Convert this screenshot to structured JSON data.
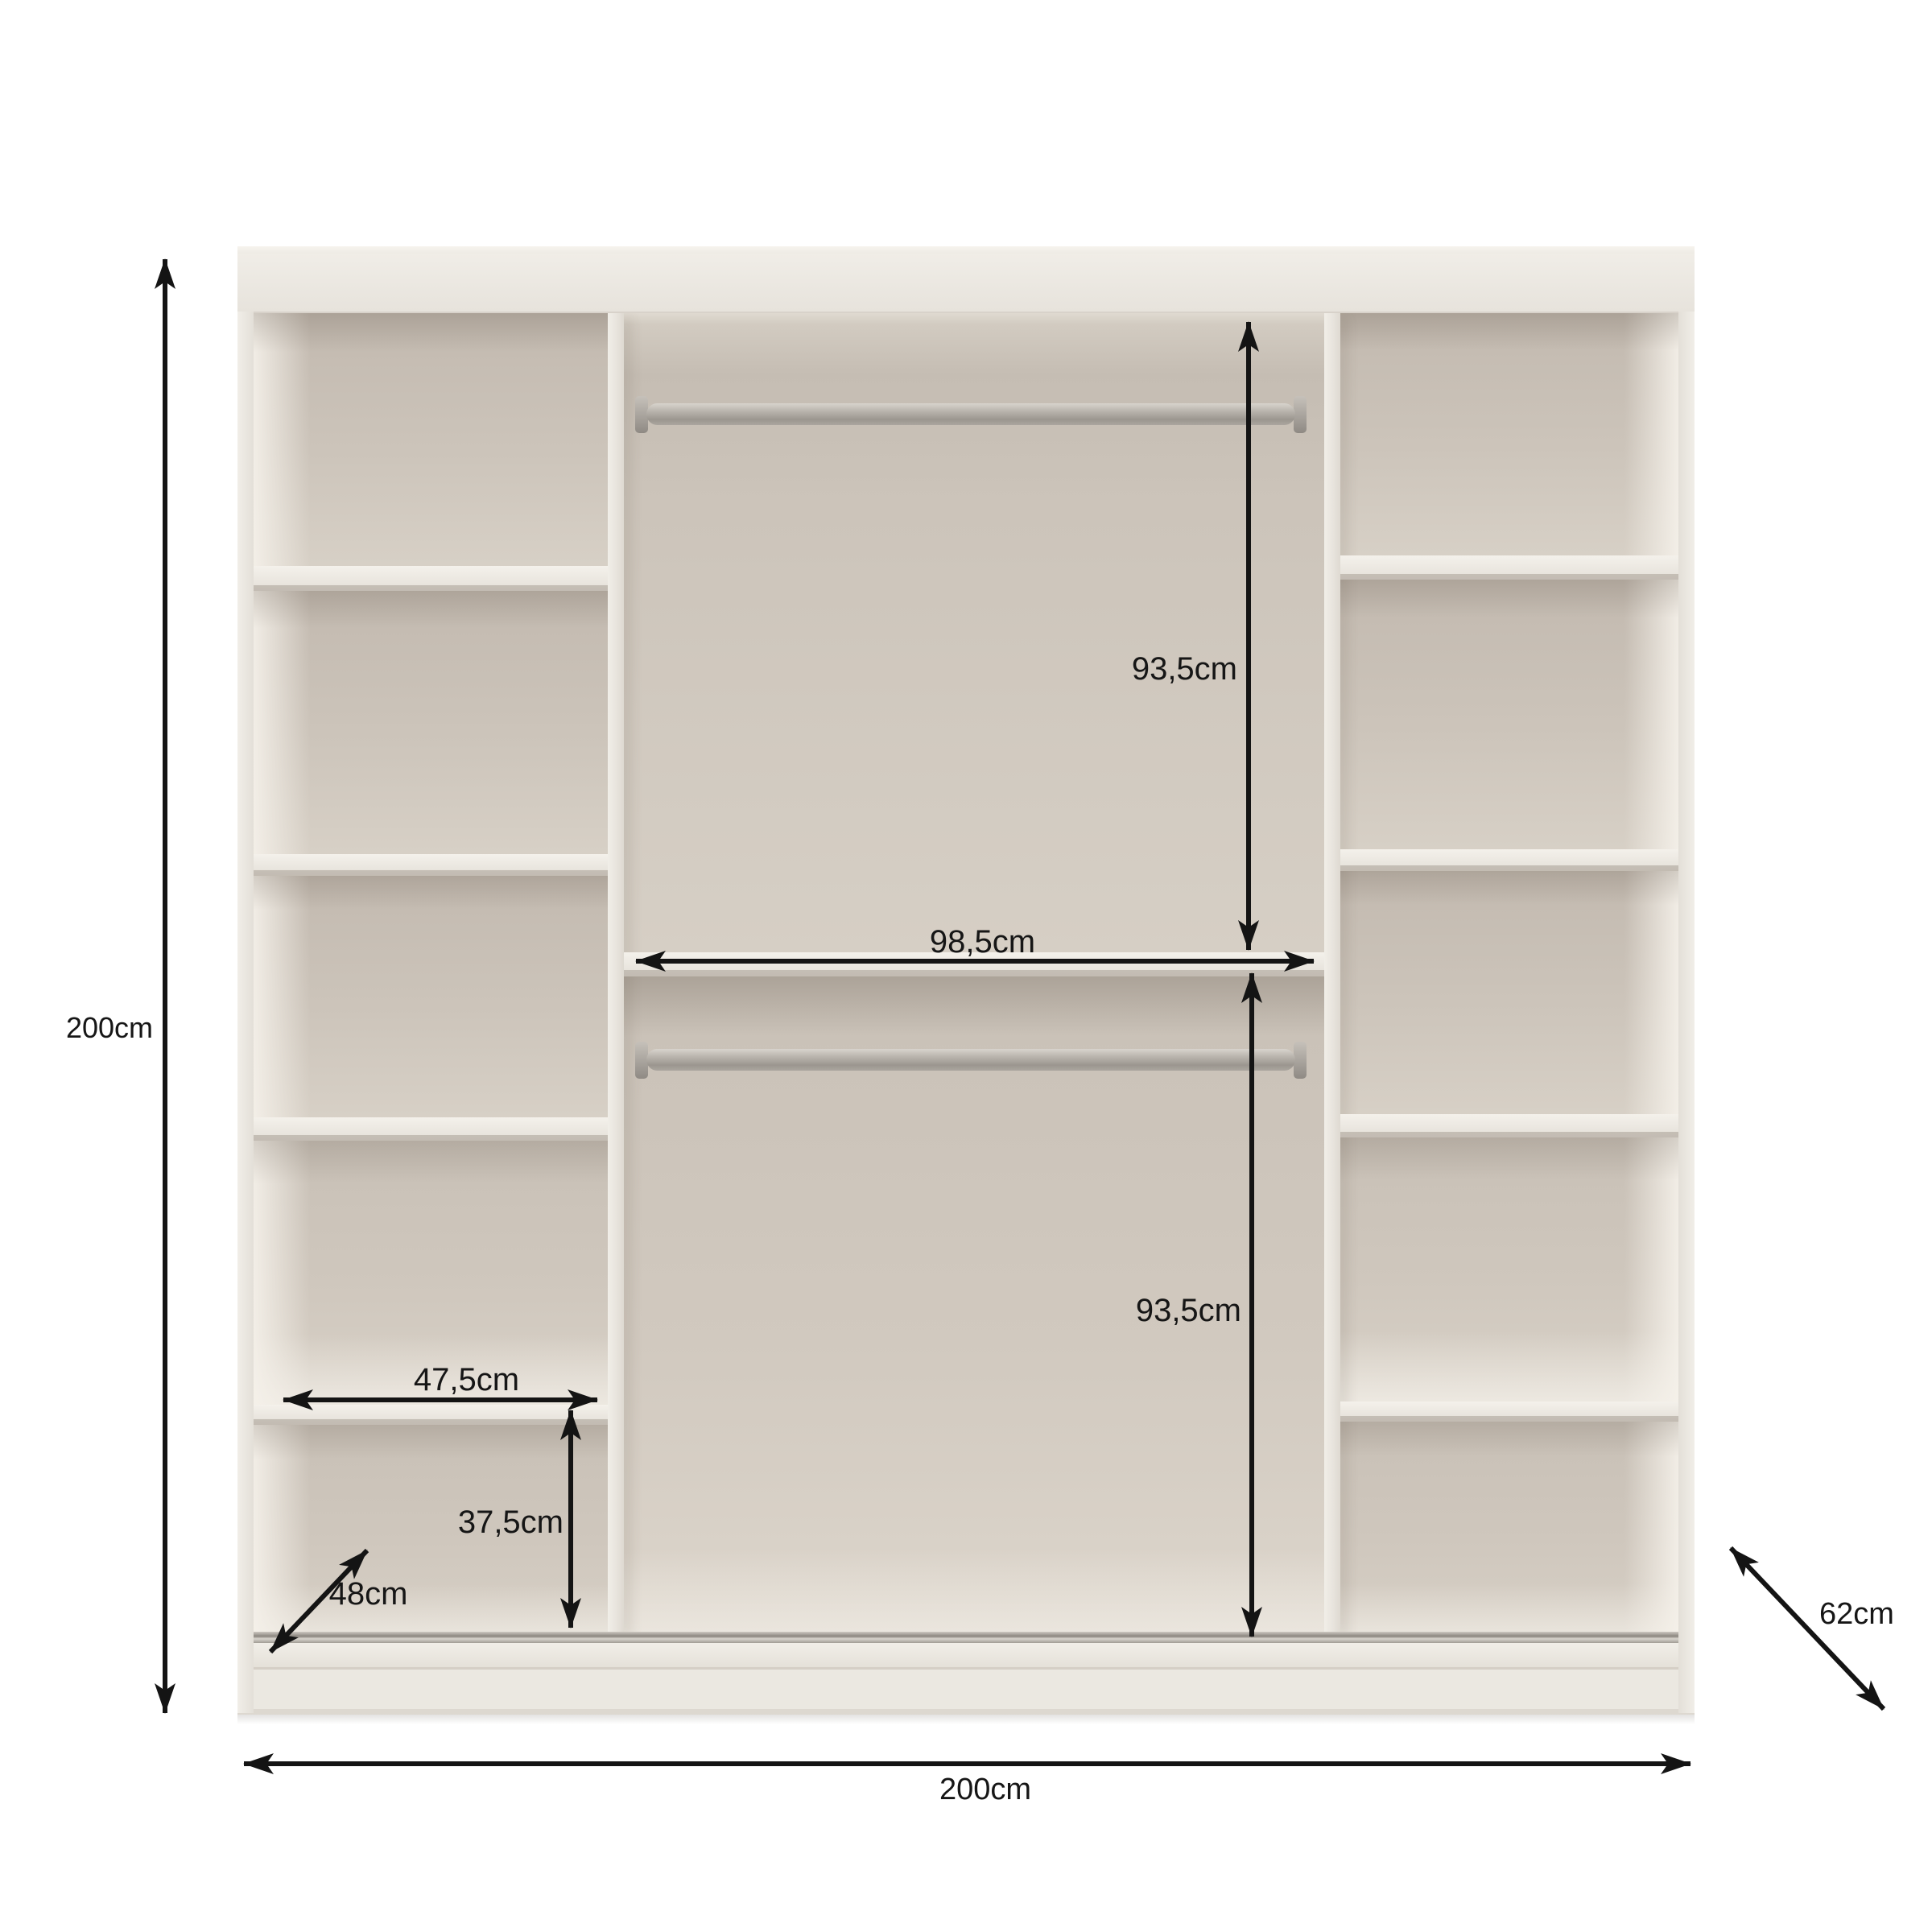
{
  "diagram": {
    "subject": "wardrobe interior with shelves and hanging rails",
    "labels": {
      "height": "200cm",
      "width": "200cm",
      "depth": "62cm",
      "shelf_depth": "48cm",
      "shelf_width": "47,5cm",
      "bottom_section_height": "37,5cm",
      "middle_section_width": "98,5cm",
      "upper_hanging_height": "93,5cm",
      "lower_hanging_height": "93,5cm"
    },
    "colors": {
      "background": "#ffffff",
      "cabinet_front": "#ebe7e0",
      "interior_wall": "#cdc5bb",
      "interior_shadow": "#b3aa9f",
      "shelf_edge": "#f0ede6",
      "rail_metal": "#a9a49d",
      "annotation": "#141414"
    },
    "structure": {
      "left_column_shelves": 4,
      "right_column_shelves": 4,
      "middle_shelf": 1,
      "hanging_rails": 2
    }
  }
}
